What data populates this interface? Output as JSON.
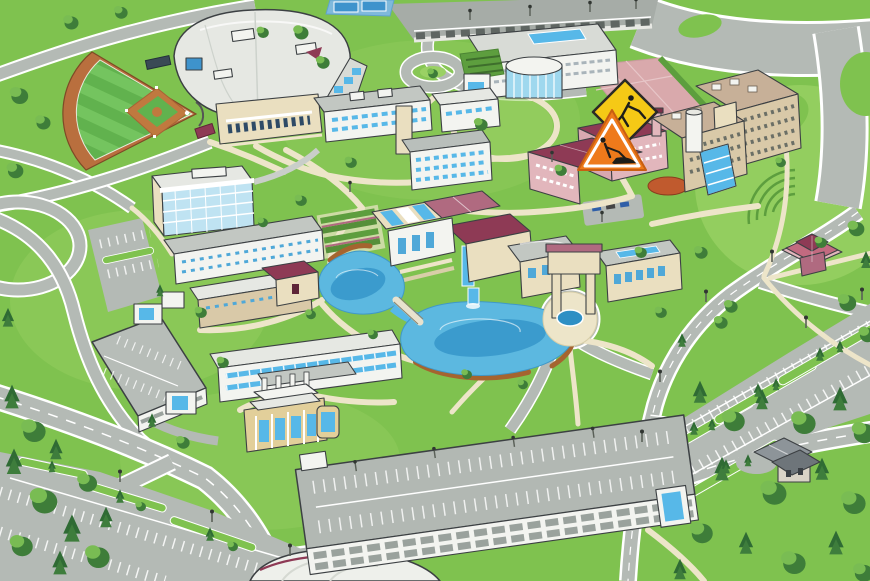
{
  "meta": {
    "title": "Isometric campus map illustration",
    "canvas": {
      "width": 870,
      "height": 581
    },
    "view": "aerial oblique, no text labels visible"
  },
  "palette": {
    "grass": "#7FC24F",
    "grassLight": "#9AD164",
    "grassDark": "#5D9E3E",
    "forest": "#3E7D39",
    "forestLight": "#79BC53",
    "conifer": "#2F6B34",
    "road": "#B4BAB5",
    "roadDark": "#A6ACA7",
    "roadLine": "#FFFFFF",
    "path": "#EDE5C9",
    "pathShadow": "#D8CEA8",
    "water": "#5CB8E0",
    "waterDeep": "#2E8FC4",
    "mud": "#A5642F",
    "outline": "#3C4043",
    "wallWhite": "#F3F4F0",
    "wallGray": "#D8DBD6",
    "beige": "#EADFC0",
    "tan": "#D9C9A8",
    "gold": "#E2CF9A",
    "roofLight": "#E6E8E3",
    "roofGray": "#C2C7C2",
    "roofSlate": "#8D9499",
    "roofDark": "#6E757A",
    "windowBlue": "#8FD0EA",
    "windowMid": "#4FA8D8",
    "glass": "#57B8E8",
    "pink": "#E2B6BC",
    "plaza": "#D9A9AC",
    "maroon": "#8E3A55",
    "maroonLight": "#B06A80",
    "court": "#3E93CC",
    "clay": "#C0793F",
    "brick": "#C05A2E",
    "signYellow": "#F5C916",
    "signOrange": "#EE7A1B",
    "fieldGreen": "#61B24E",
    "fieldLight": "#74C45F",
    "track": "#B96F3E"
  },
  "construction_signs": {
    "diamond": {
      "shape": "diamond",
      "glyph": "digging-worker",
      "border": "#2A2A26"
    },
    "triangle": {
      "shape": "triangle",
      "glyph": "roadwork-worker-with-mound",
      "inner_border": "#FFFFFF"
    }
  },
  "features": [
    {
      "id": "baseball-field",
      "label": "Baseball field with striped outfield",
      "kind": "athletic"
    },
    {
      "id": "athletics-arena",
      "label": "Large arena with curved white roof and beige entrance",
      "kind": "building"
    },
    {
      "id": "tennis-courts",
      "label": "Tennis courts at north edge",
      "kind": "athletic"
    },
    {
      "id": "north-parking-deck",
      "label": "North parking deck with lamp posts",
      "kind": "parking"
    },
    {
      "id": "library-rotunda",
      "label": "Library with blue rotunda and green roof terrace",
      "kind": "building"
    },
    {
      "id": "science-complex",
      "label": "Science and engineering complex",
      "kind": "building"
    },
    {
      "id": "glass-office-building",
      "label": "Five-story glass office building",
      "kind": "building"
    },
    {
      "id": "west-residence-rows",
      "label": "West residence hall rows with maroon-roof hall",
      "kind": "housing"
    },
    {
      "id": "central-lawn",
      "label": "Central circular lawn with perimeter path",
      "kind": "landscape"
    },
    {
      "id": "pink-plaza",
      "label": "Pink paved plaza",
      "kind": "landscape"
    },
    {
      "id": "pink-academic-building",
      "label": "Pink academic building with maroon hip roofs",
      "kind": "building"
    },
    {
      "id": "construction-zone",
      "label": "Construction zone markers over pink building",
      "kind": "status"
    },
    {
      "id": "east-residence-complex",
      "label": "Tan residence complex with glass atrium and cylinder tower",
      "kind": "housing"
    },
    {
      "id": "hillside-amphitheater",
      "label": "Hillside lawn with amphitheater terraces",
      "kind": "landscape"
    },
    {
      "id": "hill-pavilion",
      "label": "Pink pavilion with multi-gabled roof",
      "kind": "building"
    },
    {
      "id": "campus-pond",
      "label": "Two-lobe pond with footbridge and waterfall",
      "kind": "water"
    },
    {
      "id": "student-center",
      "label": "Student center cluster with maroon roofs and skylights",
      "kind": "building"
    },
    {
      "id": "arch-tower-fountain",
      "label": "Arch tower with circular fountain plaza",
      "kind": "landmark"
    },
    {
      "id": "east-hall",
      "label": "Hall with gray roof and window band",
      "kind": "building"
    },
    {
      "id": "terraced-gardens",
      "label": "Terraced garden beds by pond",
      "kind": "landscape"
    },
    {
      "id": "south-residence-hall",
      "label": "Long residence hall with blue window bands",
      "kind": "housing"
    },
    {
      "id": "heating-plant",
      "label": "Heating plant with four chimneys",
      "kind": "building"
    },
    {
      "id": "west-parking-garage",
      "label": "West parking garage with stair towers",
      "kind": "parking"
    },
    {
      "id": "south-parking-garage",
      "label": "Large south parking structure with rooftop deck",
      "kind": "parking"
    },
    {
      "id": "southeast-parking-lot",
      "label": "South-east surface lot with tree islands",
      "kind": "parking"
    },
    {
      "id": "southwest-parking-lot",
      "label": "South-west surface lot with tree islands",
      "kind": "parking"
    },
    {
      "id": "dome-roof",
      "label": "White dome roof at south-west corner",
      "kind": "building"
    },
    {
      "id": "woodland-house",
      "label": "Small gabled house in the woods",
      "kind": "building"
    },
    {
      "id": "ring-roads",
      "label": "Campus ring roads and boulevards",
      "kind": "road"
    },
    {
      "id": "woodland",
      "label": "Forest clusters on west, south and east edges",
      "kind": "landscape"
    }
  ]
}
